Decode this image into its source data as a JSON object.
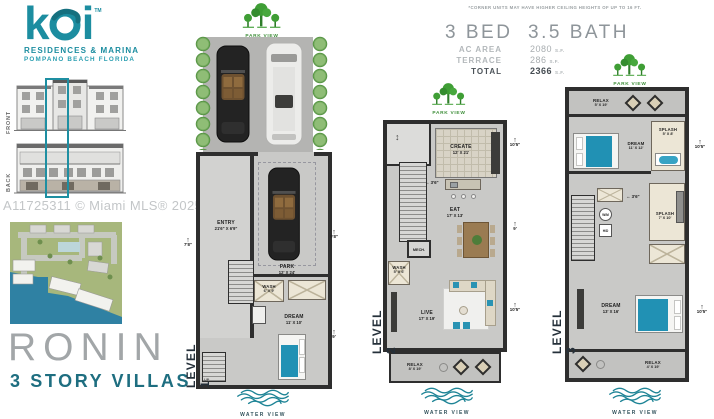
{
  "brand": {
    "logo_k": "k",
    "logo_i": "i",
    "tm": "TM",
    "line1": "RESIDENCES & MARINA",
    "line2": "POMPANO BEACH FLORIDA",
    "front": "FRONT",
    "back": "BACK"
  },
  "watermark": "A11725311 © Miami MLS® 2025",
  "title": {
    "name": "RONIN",
    "subtitle": "3 STORY VILLAS"
  },
  "summary": {
    "disclaimer": "*CORNER UNITS MAY HAVE HIGHER CEILING HEIGHTS OF UP TO 16 FT.",
    "beds": "3 BED",
    "baths": "3.5 BATH",
    "ac_label": "AC AREA",
    "ac_value": "2080",
    "ac_unit": "S.F.",
    "terrace_label": "TERRACE",
    "terrace_value": "286",
    "terrace_unit": "S.F.",
    "total_label": "TOTAL",
    "total_value": "2366",
    "total_unit": "S.F."
  },
  "views": {
    "park": "PARK VIEW",
    "water": "WATER VIEW"
  },
  "level1": {
    "label": "LEVEL 1",
    "entry_name": "ENTRY",
    "entry_dims": "21'6\" X 6'9\"",
    "park_name": "PARK",
    "park_dims": "12' X 24'",
    "wash_name": "WASH",
    "wash_dims": "6' X 9'",
    "dream_name": "DREAM",
    "dream_dims": "11' X 10'",
    "up": "UP",
    "dim_left": "7'8\"",
    "dim_right_top": "9'8\"",
    "dim_right_bottom": "9'"
  },
  "level2": {
    "label": "LEVEL 2",
    "create_name": "CREATE",
    "create_dims": "12' X 21'",
    "eat_name": "EAT",
    "eat_dims": "17' X 13'",
    "mech_name": "MECH.",
    "wash_name": "WASH",
    "wash_dims": "5' X 6'",
    "live_name": "LIVE",
    "live_dims": "17' X 19'",
    "relax_name": "RELAX",
    "relax_dims": "8' X 19'",
    "dim_island": "3'6\"",
    "dim_right_top": "10'5\"",
    "dim_right_mid": "9'",
    "dim_right_bottom": "10'5\""
  },
  "level3": {
    "label": "LEVEL 3",
    "relax_top_name": "RELAX",
    "relax_top_dims": "5' X 19'",
    "dream_top_name": "DREAM",
    "dream_top_dims": "11' X 12'",
    "splash_top_name": "SPLASH",
    "splash_top_dims": "5' X 8'",
    "wm": "W/M",
    "hd": "H/D",
    "splash_mid_name": "SPLASH",
    "splash_mid_dims": "7' X 10'",
    "dream_main_name": "DREAM",
    "dream_main_dims": "13' X 16'",
    "relax_bottom_name": "RELAX",
    "relax_bottom_dims": "4' X 19'",
    "dim_closet": "3'6\"",
    "dim_right_top": "10'5\"",
    "dim_right_bottom": "10'5\""
  },
  "colors": {
    "teal": "#1c8da0",
    "green": "#3f9e35",
    "bed_teal": "#2191b4",
    "wall": "#2e2e2e"
  }
}
